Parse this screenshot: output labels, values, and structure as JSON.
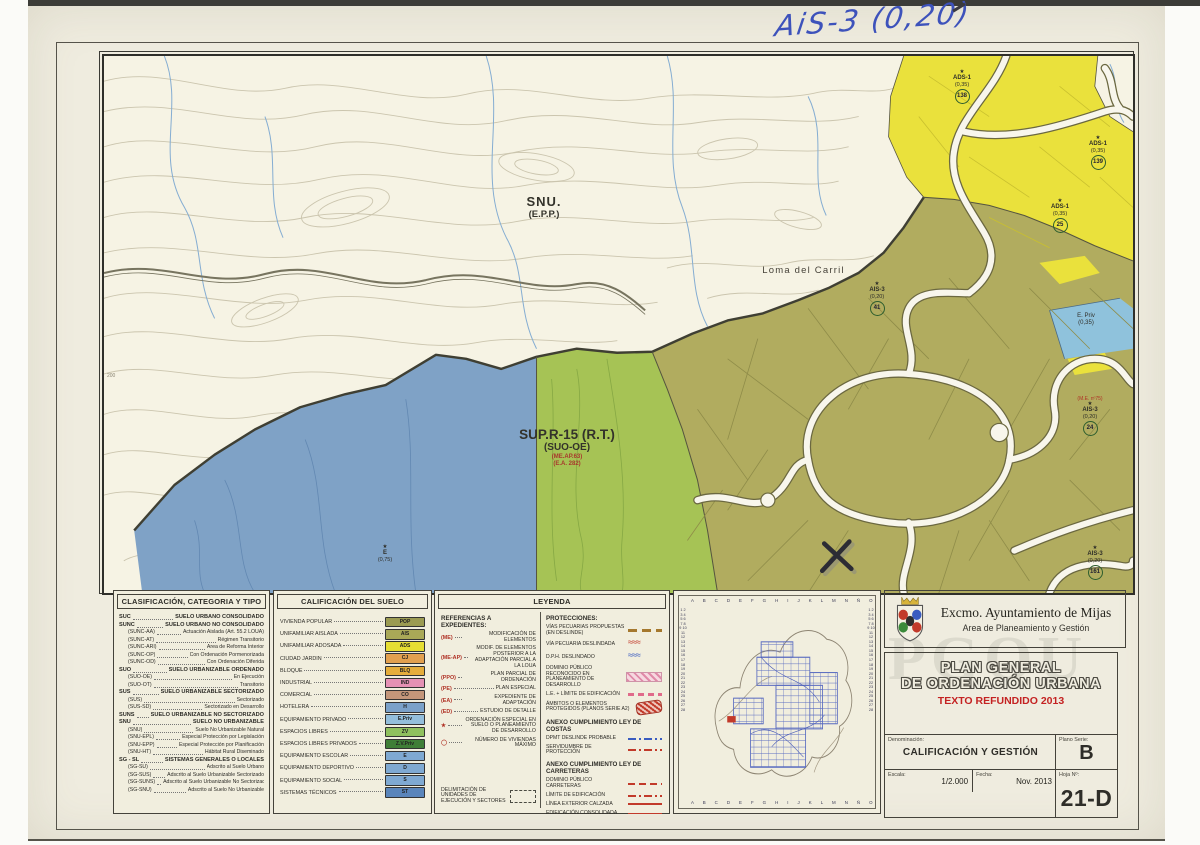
{
  "annotation": {
    "handwriting": "AiS-3 (0,20)"
  },
  "map": {
    "snu": {
      "line1": "SNU.",
      "line2": "(E.P.P.)"
    },
    "loma": "Loma del Carril",
    "sup": {
      "line1": "SUP.R-15 (R.T.)",
      "line2": "(SUO-OE)",
      "line3": "(ME.AP.63)",
      "line4": "(E.A. 282)"
    },
    "epriv": {
      "line1": "E. Priv",
      "line2": "(0,35)"
    },
    "contour_label": "200",
    "markers": [
      {
        "code": "ADS-1",
        "ratio": "(0,35)",
        "num": "138",
        "x": "836px",
        "y": "14px"
      },
      {
        "code": "ADS-1",
        "ratio": "(0,35)",
        "num": "139",
        "x": "972px",
        "y": "80px"
      },
      {
        "code": "ADS-1",
        "ratio": "(0,35)",
        "num": "25",
        "x": "934px",
        "y": "143px"
      },
      {
        "code": "AIS-3",
        "ratio": "(0,20)",
        "num": "41",
        "x": "751px",
        "y": "226px"
      },
      {
        "code": "AIS-3",
        "ratio": "(0,20)",
        "num": "24",
        "x": "964px",
        "y": "340px",
        "ref": "(M.E. nº75)"
      },
      {
        "code": "AIS-3",
        "ratio": "(0,20)",
        "num": "161",
        "x": "969px",
        "y": "490px"
      },
      {
        "code": "E",
        "ratio": "(0,75)",
        "x": "259px",
        "y": "489px"
      }
    ]
  },
  "clasificacion": {
    "title": "CLASIFICACIÓN, CATEGORIA Y TIPO",
    "items": [
      {
        "code": "SUC",
        "label": "SUELO URBANO CONSOLIDADO",
        "style": "top"
      },
      {
        "code": "SUNC",
        "label": "SUELO URBANO NO CONSOLIDADO",
        "style": "top"
      },
      {
        "code": "(SUNC-AA)",
        "label": "Actuación Aislada (Art. 55.2 LOUA)",
        "style": "sub"
      },
      {
        "code": "(SUNC-AT)",
        "label": "Régimen Transitorio",
        "style": "sub"
      },
      {
        "code": "(SUNC-ARI)",
        "label": "Área de Reforma Interior",
        "style": "sub"
      },
      {
        "code": "(SUNC-OP)",
        "label": "Con Ordenación Pormenorizada",
        "style": "sub"
      },
      {
        "code": "(SUNC-OD)",
        "label": "Con Ordenación Diferida",
        "style": "sub"
      },
      {
        "code": "SUO",
        "label": "SUELO URBANIZABLE ORDENADO",
        "style": "top"
      },
      {
        "code": "(SUO-OE)",
        "label": "En Ejecución",
        "style": "sub"
      },
      {
        "code": "(SUO-OT)",
        "label": "Transitorio",
        "style": "sub"
      },
      {
        "code": "SUS",
        "label": "SUELO URBANIZABLE SECTORIZADO",
        "style": "top"
      },
      {
        "code": "(SUS)",
        "label": "Sectorizado",
        "style": "sub"
      },
      {
        "code": "(SUS-SD)",
        "label": "Sectorizado en Desarrollo",
        "style": "sub"
      },
      {
        "code": "SUNS",
        "label": "SUELO URBANIZABLE NO SECTORIZADO",
        "style": "top"
      },
      {
        "code": "SNU",
        "label": "SUELO NO URBANIZABLE",
        "style": "top"
      },
      {
        "code": "(SNU)",
        "label": "Suelo No Urbanizable Natural",
        "style": "sub"
      },
      {
        "code": "(SNU-EPL)",
        "label": "Especial Protección por Legislación",
        "style": "sub"
      },
      {
        "code": "(SNU-EPP)",
        "label": "Especial Protección por Planificación",
        "style": "sub"
      },
      {
        "code": "(SNU-HT)",
        "label": "Hábitat Rural Diseminado",
        "style": "sub"
      },
      {
        "code": "SG - SL",
        "label": "SISTEMAS GENERALES O LOCALES",
        "style": "top"
      },
      {
        "code": "(SG-SU)",
        "label": "Adscrito al Suelo Urbano",
        "style": "sub"
      },
      {
        "code": "(SG-SUS)",
        "label": "Adscrito al Suelo Urbanizable Sectorizado",
        "style": "sub"
      },
      {
        "code": "(SG-SUNS)",
        "label": "Adscrito al Suelo Urbanizable No Sectorizado",
        "style": "sub"
      },
      {
        "code": "(SG-SNU)",
        "label": "Adscrito al Suelo No Urbanizable",
        "style": "sub"
      }
    ]
  },
  "calificacion": {
    "title": "CALIFICACIÓN DEL SUELO",
    "items": [
      {
        "label": "VIVIENDA POPULAR",
        "code": "POP",
        "color": "#9b9b52"
      },
      {
        "label": "UNIFAMILIAR AISLADA",
        "code": "AIS",
        "color": "#a9a857"
      },
      {
        "label": "UNIFAMILIAR ADOSADA",
        "code": "ADS",
        "color": "#e6de33"
      },
      {
        "label": "CIUDAD JARDIN",
        "code": "CJ",
        "color": "#e2a04f"
      },
      {
        "label": "BLOQUE",
        "code": "BLQ",
        "color": "#e5ad3c"
      },
      {
        "label": "INDUSTRIAL",
        "code": "IND",
        "color": "#e591b4"
      },
      {
        "label": "COMERCIAL",
        "code": "CO",
        "color": "#c4967a"
      },
      {
        "label": "HOTELERA",
        "code": "H",
        "color": "#7ba1c9"
      },
      {
        "label": "EQUIPAMIENTO PRIVADO",
        "code": "E.Priv",
        "color": "#94bedb"
      },
      {
        "label": "ESPACIOS LIBRES",
        "code": "ZV",
        "color": "#8fc05e"
      },
      {
        "label": "ESPACIOS LIBRES PRIVADOS",
        "code": "Z.V.Priv",
        "color": "#3f7e37"
      },
      {
        "label": "EQUIPAMIENTO ESCOLAR",
        "code": "E",
        "color": "#7fa9d2"
      },
      {
        "label": "EQUIPAMIENTO DEPORTIVO",
        "code": "D",
        "color": "#7fa9d2"
      },
      {
        "label": "EQUIPAMIENTO SOCIAL",
        "code": "S",
        "color": "#7fa9d2"
      },
      {
        "label": "SISTEMAS TÉCNICOS",
        "code": "ST",
        "color": "#5a85bb"
      }
    ]
  },
  "leyenda": {
    "title": "LEYENDA",
    "referencias": {
      "heading": "REFERENCIAS A EXPEDIENTES:",
      "items": [
        {
          "code": "(ME)",
          "label": "MODIFICACIÓN DE ELEMENTOS"
        },
        {
          "code": "(ME-AP)",
          "label": "MODIF. DE ELEMENTOS POSTERIOR A LA ADAPTACIÓN PARCIAL A LA LOUA"
        },
        {
          "code": "(PPO)",
          "label": "PLAN PARCIAL DE ORDENACIÓN"
        },
        {
          "code": "(PE)",
          "label": "PLAN ESPECIAL"
        },
        {
          "code": "(EA)",
          "label": "EXPEDIENTE DE ADAPTACIÓN"
        },
        {
          "code": "(ED)",
          "label": "ESTUDIO DE DETALLE"
        },
        {
          "code": "★",
          "label": "ORDENACIÓN ESPECIAL EN SUELO O PLANEAMIENTO DE DESARROLLO"
        },
        {
          "code": "◯",
          "label": "NÚMERO DE VIVIENDAS MÁXIMO"
        }
      ],
      "delimitacion": "DELIMITACIÓN DE UNIDADES DE EJECUCIÓN Y SECTORES"
    },
    "protecciones": {
      "heading": "PROTECCIONES:",
      "items": [
        {
          "label": "VÍAS PECUARIAS PROPUESTAS (EN DESLINDE)",
          "sym": "sym-brown-dashes"
        },
        {
          "label": "VÍA PECUARIA DESLINDADA",
          "sym": "sym-red-waves"
        },
        {
          "label": "D.P.H. DESLINDADO",
          "sym": "sym-blue-waves"
        },
        {
          "label": "DOMINIO PÚBLICO RECONOCIDO EN PLANEAMIENTO DE DESARROLLO",
          "sym": "sym-pink-hatch"
        },
        {
          "label": "L.E. + LÍMITE DE EDIFICACIÓN",
          "sym": "sym-pink-dash"
        },
        {
          "label": "ÁMBITOS O ELEMENTOS PROTEGIDOS (PLANOS SERIE A2)",
          "sym": "sym-red-blob"
        }
      ]
    },
    "costas": {
      "heading": "ANEXO CUMPLIMIENTO LEY DE COSTAS",
      "items": [
        {
          "label": "DPMT DESLINDE PROBABLE",
          "sym": "sym-blue-dashdot"
        },
        {
          "label": "SERVIDUMBRE DE PROTECCIÓN",
          "sym": "sym-red-dashdot"
        }
      ]
    },
    "carreteras": {
      "heading": "ANEXO CUMPLIMIENTO LEY DE CARRETERAS",
      "items": [
        {
          "label": "DOMINIO PÚBLICO CARRETERAS",
          "sym": "sym-red-dash"
        },
        {
          "label": "LÍMITE DE EDIFICACIÓN",
          "sym": "sym-red-dashdot"
        },
        {
          "label": "LÍNEA EXTERIOR CALZADA",
          "sym": "sym-red-line"
        },
        {
          "label": "EDIFICACIÓN CONSOLIDADA",
          "sym": "sym-red-line2"
        }
      ]
    }
  },
  "index_map": {
    "letters": "A B C D E F G H I J K L M N Ñ O P",
    "rows": "1 2 3 4 5 6 7 8 9 10 11 12 13 14 15 16 17 18 19 20 21 22 23 24 25 26 27 28"
  },
  "title_block": {
    "org": "Excmo. Ayuntamiento de Mijas",
    "dept": "Area de Planeamiento y Gestión",
    "watermark": "PGOU",
    "title1": "PLAN GENERAL",
    "title2": "DE ORDENACIÓN URBANA",
    "subtitle": "TEXTO REFUNDIDO 2013",
    "denominacion_label": "Denominación:",
    "denominacion_value": "CALIFICACIÓN Y GESTIÓN",
    "plano_serie_label": "Plano Serie:",
    "plano_serie_value": "B",
    "escala_label": "Escala:",
    "escala_value": "1/2.000",
    "fecha_label": "Fecha:",
    "fecha_value": "Nov. 2013",
    "hoja_label": "Hoja Nº:",
    "hoja_value": "21-D"
  }
}
